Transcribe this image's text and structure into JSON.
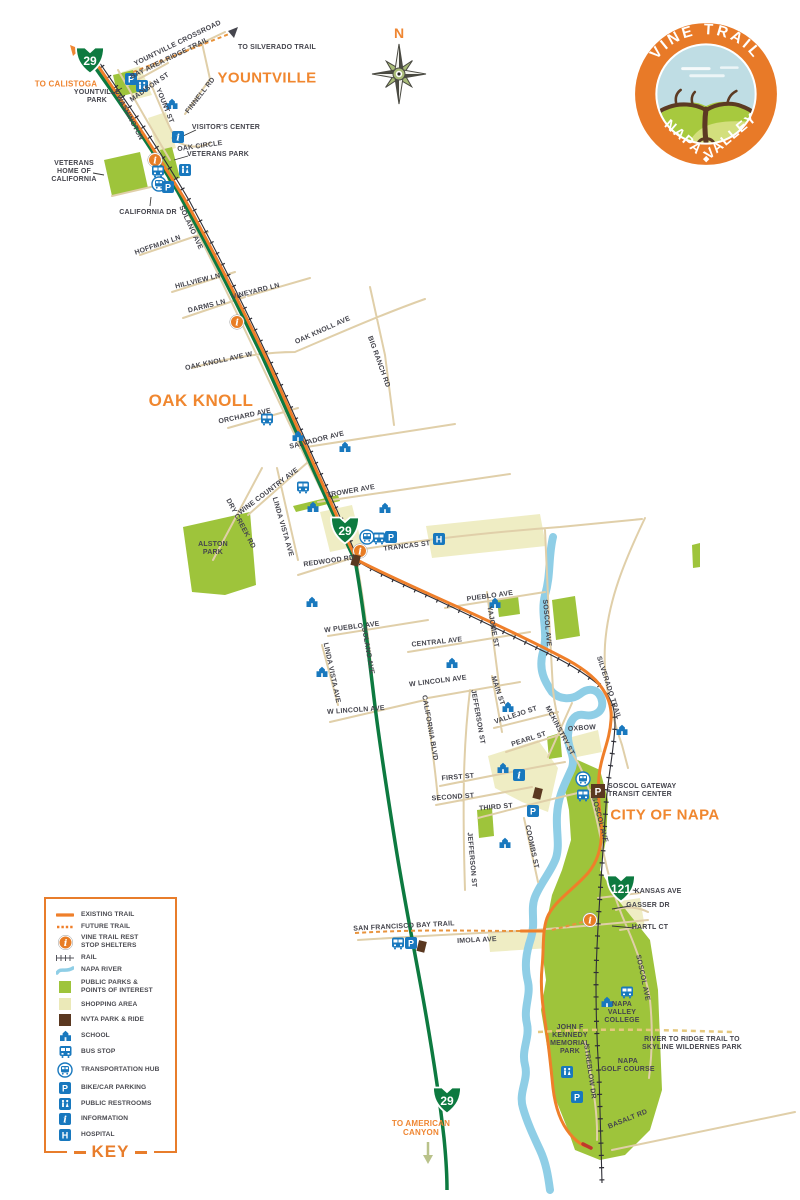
{
  "logo": {
    "top_text": "VINE TRAIL",
    "bottom_left": "NAPA",
    "bottom_right": "VALLEY"
  },
  "compass": {
    "north_label": "N"
  },
  "icon_glyphs": {
    "parking": "P",
    "information": "i",
    "hospital": "H",
    "reststop": "i"
  },
  "colors": {
    "accent_orange": "#ef7f2a",
    "highway_green": "#0d7a40",
    "icon_blue": "#1878be",
    "park_green": "#9ec43b",
    "shopping": "#efedc4",
    "nvta_brown": "#5a3820",
    "river_blue": "#8fcee6"
  },
  "shields": [
    {
      "num": "29",
      "x": 90,
      "y": 60
    },
    {
      "num": "29",
      "x": 345,
      "y": 530
    },
    {
      "num": "29",
      "x": 447,
      "y": 1100
    },
    {
      "num": "121",
      "x": 621,
      "y": 888
    }
  ],
  "labels": [
    {
      "id": "yountville-crossroad",
      "t": "YOUNTVILLE CROSSROAD",
      "x": 178,
      "y": 44,
      "r": -26,
      "cls": "s"
    },
    {
      "id": "bay-area-ridge-trail",
      "t": "BAY AREA RIDGE TRAIL",
      "x": 170,
      "y": 59,
      "r": -26,
      "cls": "s"
    },
    {
      "id": "to-silverado-trail",
      "t": "TO SILVERADO TRAIL",
      "x": 277,
      "y": 48,
      "cls": "s"
    },
    {
      "id": "madison-st",
      "t": "MADISON ST",
      "x": 150,
      "y": 88,
      "r": -35,
      "cls": "s"
    },
    {
      "id": "finnell-rd",
      "t": "FINNELL RD",
      "x": 201,
      "y": 96,
      "r": -52,
      "cls": "s"
    },
    {
      "id": "yount-st",
      "t": "YOUNT ST",
      "x": 164,
      "y": 106,
      "r": 68,
      "cls": "s"
    },
    {
      "id": "washington-st",
      "t": "WASHINGTON",
      "x": 129,
      "y": 118,
      "r": 62,
      "cls": "s"
    },
    {
      "id": "oak-circle",
      "t": "OAK CIRCLE",
      "x": 200,
      "y": 147,
      "r": -8,
      "cls": "s"
    },
    {
      "id": "visitors-center",
      "t": "VISITOR'S CENTER",
      "x": 226,
      "y": 128,
      "cls": "s"
    },
    {
      "id": "veterans-park",
      "t": "VETERANS PARK",
      "x": 218,
      "y": 155,
      "cls": "s"
    },
    {
      "id": "yountville-park",
      "t": "YOUNTVILLE\nPARK",
      "x": 97,
      "y": 97,
      "cls": "s"
    },
    {
      "id": "veterans-home",
      "t": "VETERANS\nHOME OF\nCALIFORNIA",
      "x": 74,
      "y": 172,
      "cls": "s"
    },
    {
      "id": "california-dr",
      "t": "CALIFORNIA DR",
      "x": 148,
      "y": 213,
      "cls": "s"
    },
    {
      "id": "solano-ave-n",
      "t": "SOLANO AVE",
      "x": 190,
      "y": 228,
      "r": 65,
      "cls": "s"
    },
    {
      "id": "hoffman-ln",
      "t": "HOFFMAN LN",
      "x": 158,
      "y": 246,
      "r": -19,
      "cls": "s"
    },
    {
      "id": "hillview-ln",
      "t": "HILLVIEW LN",
      "x": 198,
      "y": 282,
      "r": -14,
      "cls": "s"
    },
    {
      "id": "darms-ln",
      "t": "DARMS LN",
      "x": 207,
      "y": 307,
      "r": -14,
      "cls": "s"
    },
    {
      "id": "vineyard-ln",
      "t": "VINEYARD LN",
      "x": 256,
      "y": 292,
      "r": -14,
      "cls": "s"
    },
    {
      "id": "oak-knoll-ave-w",
      "t": "OAK KNOLL AVE W",
      "x": 219,
      "y": 362,
      "r": -12,
      "cls": "s"
    },
    {
      "id": "oak-knoll-ave",
      "t": "OAK KNOLL AVE",
      "x": 323,
      "y": 331,
      "r": -24,
      "cls": "s"
    },
    {
      "id": "big-ranch-rd",
      "t": "BIG RANCH RD",
      "x": 378,
      "y": 362,
      "r": 70,
      "cls": "s"
    },
    {
      "id": "orchard-ave",
      "t": "ORCHARD AVE",
      "x": 245,
      "y": 417,
      "r": -12,
      "cls": "s"
    },
    {
      "id": "salvador-ave",
      "t": "SALVADOR AVE",
      "x": 317,
      "y": 441,
      "r": -14,
      "cls": "s"
    },
    {
      "id": "wine-country-ave",
      "t": "WINE COUNTRY AVE",
      "x": 269,
      "y": 492,
      "r": -37,
      "cls": "s"
    },
    {
      "id": "trower-ave",
      "t": "TROWER AVE",
      "x": 351,
      "y": 492,
      "r": -10,
      "cls": "s"
    },
    {
      "id": "dry-creek-rd",
      "t": "DRY CREEK RD",
      "x": 240,
      "y": 524,
      "r": 62,
      "cls": "s"
    },
    {
      "id": "linda-vista-ave-n",
      "t": "LINDA VISTA AVE",
      "x": 282,
      "y": 527,
      "r": 74,
      "cls": "s"
    },
    {
      "id": "alston-park",
      "t": "ALSTON\nPARK",
      "x": 213,
      "y": 549,
      "cls": "s"
    },
    {
      "id": "redwood-rd",
      "t": "REDWOOD RD",
      "x": 329,
      "y": 562,
      "r": -8,
      "cls": "s"
    },
    {
      "id": "trancas-st",
      "t": "TRANCAS ST",
      "x": 407,
      "y": 547,
      "r": -7,
      "cls": "s"
    },
    {
      "id": "w-pueblo-ave",
      "t": "W PUEBLO AVE",
      "x": 352,
      "y": 628,
      "r": -7,
      "cls": "s"
    },
    {
      "id": "pueblo-ave",
      "t": "PUEBLO AVE",
      "x": 490,
      "y": 597,
      "r": -8,
      "cls": "s"
    },
    {
      "id": "central-ave",
      "t": "CENTRAL AVE",
      "x": 437,
      "y": 643,
      "r": -6,
      "cls": "s"
    },
    {
      "id": "yajome-st",
      "t": "YAJOME ST",
      "x": 492,
      "y": 627,
      "r": 80,
      "cls": "s"
    },
    {
      "id": "soscol-ave-n",
      "t": "SOSCOL AVE",
      "x": 546,
      "y": 623,
      "r": 85,
      "cls": "s"
    },
    {
      "id": "silverado-trail",
      "t": "SILVERADO TRAIL",
      "x": 608,
      "y": 688,
      "r": 72,
      "cls": "s"
    },
    {
      "id": "linda-vista-ave-s",
      "t": "LINDA VISTA AVE",
      "x": 331,
      "y": 673,
      "r": 78,
      "cls": "s"
    },
    {
      "id": "solano-ave-s",
      "t": "SOLANO AVE",
      "x": 367,
      "y": 651,
      "r": 80,
      "cls": "s"
    },
    {
      "id": "w-lincoln-ave-e",
      "t": "W LINCOLN AVE",
      "x": 438,
      "y": 682,
      "r": -7,
      "cls": "s"
    },
    {
      "id": "w-lincoln-ave-w",
      "t": "W LINCOLN AVE",
      "x": 356,
      "y": 711,
      "r": -4,
      "cls": "s"
    },
    {
      "id": "california-blvd",
      "t": "CALIFORNIA BLVD",
      "x": 429,
      "y": 728,
      "r": 80,
      "cls": "s"
    },
    {
      "id": "jefferson-st-n",
      "t": "JEFFERSON ST",
      "x": 477,
      "y": 717,
      "r": 80,
      "cls": "s"
    },
    {
      "id": "main-st",
      "t": "MAIN ST",
      "x": 497,
      "y": 691,
      "r": 72,
      "cls": "s"
    },
    {
      "id": "vallejo-st",
      "t": "VALLEJO ST",
      "x": 516,
      "y": 716,
      "r": -18,
      "cls": "s"
    },
    {
      "id": "mckinstry-st",
      "t": "MCKINSTRY ST",
      "x": 559,
      "y": 731,
      "r": 62,
      "cls": "s"
    },
    {
      "id": "pearl-st",
      "t": "PEARL ST",
      "x": 529,
      "y": 740,
      "r": -18,
      "cls": "s"
    },
    {
      "id": "oxbow",
      "t": "OXBOW",
      "x": 582,
      "y": 729,
      "r": -4,
      "cls": "s"
    },
    {
      "id": "first-st",
      "t": "FIRST ST",
      "x": 458,
      "y": 778,
      "r": -5,
      "cls": "s"
    },
    {
      "id": "second-st",
      "t": "SECOND ST",
      "x": 453,
      "y": 798,
      "r": -4,
      "cls": "s"
    },
    {
      "id": "third-st",
      "t": "THIRD ST",
      "x": 496,
      "y": 808,
      "r": -5,
      "cls": "s"
    },
    {
      "id": "jefferson-st-s",
      "t": "JEFFERSON ST",
      "x": 471,
      "y": 860,
      "r": 85,
      "cls": "s"
    },
    {
      "id": "coombs-st",
      "t": "COOMBS ST",
      "x": 531,
      "y": 847,
      "r": 78,
      "cls": "s"
    },
    {
      "id": "soscol-gateway",
      "t": "SOSCOL GATEWAY\nTRANSIT CENTER",
      "x": 608,
      "y": 791,
      "cls": "s",
      "a": "left"
    },
    {
      "id": "soscol-ave-mid",
      "t": "SOSCOL AVE",
      "x": 599,
      "y": 820,
      "r": 75,
      "cls": "s"
    },
    {
      "id": "kansas-ave",
      "t": "KANSAS AVE",
      "x": 658,
      "y": 892,
      "cls": "s"
    },
    {
      "id": "gasser-dr",
      "t": "GASSER DR",
      "x": 648,
      "y": 906,
      "cls": "s"
    },
    {
      "id": "hartl-ct",
      "t": "HARTL CT",
      "x": 650,
      "y": 928,
      "cls": "s"
    },
    {
      "id": "sf-bay-trail",
      "t": "SAN FRANCISCO BAY TRAIL",
      "x": 404,
      "y": 927,
      "r": -3,
      "cls": "s"
    },
    {
      "id": "imola-ave",
      "t": "IMOLA AVE",
      "x": 477,
      "y": 941,
      "r": -3,
      "cls": "s"
    },
    {
      "id": "soscol-ave-s",
      "t": "SOSCOL AVE",
      "x": 642,
      "y": 978,
      "r": 78,
      "cls": "s"
    },
    {
      "id": "napa-valley-college",
      "t": "NAPA\nVALLEY\nCOLLEGE",
      "x": 622,
      "y": 1013,
      "cls": "s"
    },
    {
      "id": "jfk-park",
      "t": "JOHN F\nKENNEDY\nMEMORIAL\nPARK",
      "x": 570,
      "y": 1040,
      "cls": "s"
    },
    {
      "id": "napa-golf-course",
      "t": "NAPA\nGOLF COURSE",
      "x": 628,
      "y": 1066,
      "cls": "s"
    },
    {
      "id": "streblow-dr",
      "t": "STREBLOW DR",
      "x": 589,
      "y": 1072,
      "r": 82,
      "cls": "s"
    },
    {
      "id": "basalt-rd",
      "t": "BASALT RD",
      "x": 628,
      "y": 1120,
      "r": -22,
      "cls": "s"
    },
    {
      "id": "river-to-ridge",
      "t": "RIVER TO RIDGE TRAIL TO\nSKYLINE WILDERNES PARK",
      "x": 692,
      "y": 1044,
      "cls": "s"
    },
    {
      "id": "to-calistoga",
      "t": "TO CALISTOGA",
      "x": 66,
      "y": 84,
      "cls": "o"
    },
    {
      "id": "to-american-canyon",
      "t": "TO AMERICAN\nCANYON",
      "x": 421,
      "y": 1128,
      "cls": "o"
    },
    {
      "id": "yountville-area",
      "t": "YOUNTVILLE",
      "x": 267,
      "y": 78,
      "cls": "a"
    },
    {
      "id": "oak-knoll-area",
      "t": "OAK KNOLL",
      "x": 201,
      "y": 401,
      "cls": "a",
      "sz": 17
    },
    {
      "id": "city-of-napa-area",
      "t": "CITY OF NAPA",
      "x": 665,
      "y": 815,
      "cls": "a"
    }
  ],
  "icons": [
    {
      "t": "reststop",
      "x": 155,
      "y": 160
    },
    {
      "t": "reststop",
      "x": 237,
      "y": 322
    },
    {
      "t": "reststop",
      "x": 360,
      "y": 551
    },
    {
      "t": "reststop",
      "x": 590,
      "y": 920
    },
    {
      "t": "hub",
      "x": 159,
      "y": 184
    },
    {
      "t": "hub",
      "x": 367,
      "y": 537
    },
    {
      "t": "hub",
      "x": 583,
      "y": 779
    },
    {
      "t": "bus",
      "x": 158,
      "y": 171
    },
    {
      "t": "bus",
      "x": 379,
      "y": 538
    },
    {
      "t": "bus",
      "x": 583,
      "y": 795
    },
    {
      "t": "bus",
      "x": 267,
      "y": 419
    },
    {
      "t": "bus",
      "x": 303,
      "y": 487
    },
    {
      "t": "bus",
      "x": 398,
      "y": 943
    },
    {
      "t": "bus",
      "x": 627,
      "y": 992
    },
    {
      "t": "parking",
      "x": 131,
      "y": 79
    },
    {
      "t": "parking",
      "x": 168,
      "y": 187
    },
    {
      "t": "parking",
      "x": 391,
      "y": 537
    },
    {
      "t": "parking",
      "x": 533,
      "y": 811
    },
    {
      "t": "parking",
      "x": 411,
      "y": 943
    },
    {
      "t": "parking",
      "x": 577,
      "y": 1097
    },
    {
      "t": "parking-nvta",
      "x": 598,
      "y": 791
    },
    {
      "t": "restroom",
      "x": 142,
      "y": 86
    },
    {
      "t": "restroom",
      "x": 185,
      "y": 170
    },
    {
      "t": "restroom",
      "x": 567,
      "y": 1072
    },
    {
      "t": "info",
      "x": 178,
      "y": 137
    },
    {
      "t": "info",
      "x": 519,
      "y": 775
    },
    {
      "t": "hospital",
      "x": 439,
      "y": 539
    },
    {
      "t": "school",
      "x": 172,
      "y": 104
    },
    {
      "t": "school",
      "x": 298,
      "y": 436
    },
    {
      "t": "school",
      "x": 345,
      "y": 447
    },
    {
      "t": "school",
      "x": 313,
      "y": 507
    },
    {
      "t": "school",
      "x": 385,
      "y": 508
    },
    {
      "t": "school",
      "x": 495,
      "y": 603
    },
    {
      "t": "school",
      "x": 312,
      "y": 602
    },
    {
      "t": "school",
      "x": 322,
      "y": 672
    },
    {
      "t": "school",
      "x": 452,
      "y": 663
    },
    {
      "t": "school",
      "x": 508,
      "y": 707
    },
    {
      "t": "school",
      "x": 503,
      "y": 768
    },
    {
      "t": "school",
      "x": 505,
      "y": 843
    },
    {
      "t": "school",
      "x": 622,
      "y": 730
    },
    {
      "t": "school",
      "x": 607,
      "y": 1002
    },
    {
      "t": "nvta",
      "x": 356,
      "y": 561
    },
    {
      "t": "nvta",
      "x": 538,
      "y": 794
    },
    {
      "t": "nvta",
      "x": 422,
      "y": 947
    }
  ],
  "legend": {
    "title": "KEY",
    "items": [
      {
        "t": "line-solid",
        "label": "EXISTING TRAIL"
      },
      {
        "t": "line-dashed",
        "label": "FUTURE TRAIL"
      },
      {
        "t": "reststop",
        "label": "VINE TRAIL REST\nSTOP SHELTERS"
      },
      {
        "t": "rail",
        "label": "RAIL"
      },
      {
        "t": "river",
        "label": "NAPA RIVER"
      },
      {
        "t": "sq-park",
        "label": "PUBLIC PARKS &\nPOINTS OF INTEREST"
      },
      {
        "t": "sq-shop",
        "label": "SHOPPING AREA"
      },
      {
        "t": "sq-nvta",
        "label": "NVTA PARK & RIDE"
      },
      {
        "t": "school",
        "label": "SCHOOL"
      },
      {
        "t": "bus",
        "label": "BUS STOP"
      },
      {
        "t": "hub",
        "label": "TRANSPORTATION HUB"
      },
      {
        "t": "parking",
        "label": "BIKE/CAR PARKING"
      },
      {
        "t": "restroom",
        "label": "PUBLIC RESTROOMS"
      },
      {
        "t": "info",
        "label": "INFORMATION"
      },
      {
        "t": "hospital",
        "label": "HOSPITAL"
      }
    ]
  }
}
